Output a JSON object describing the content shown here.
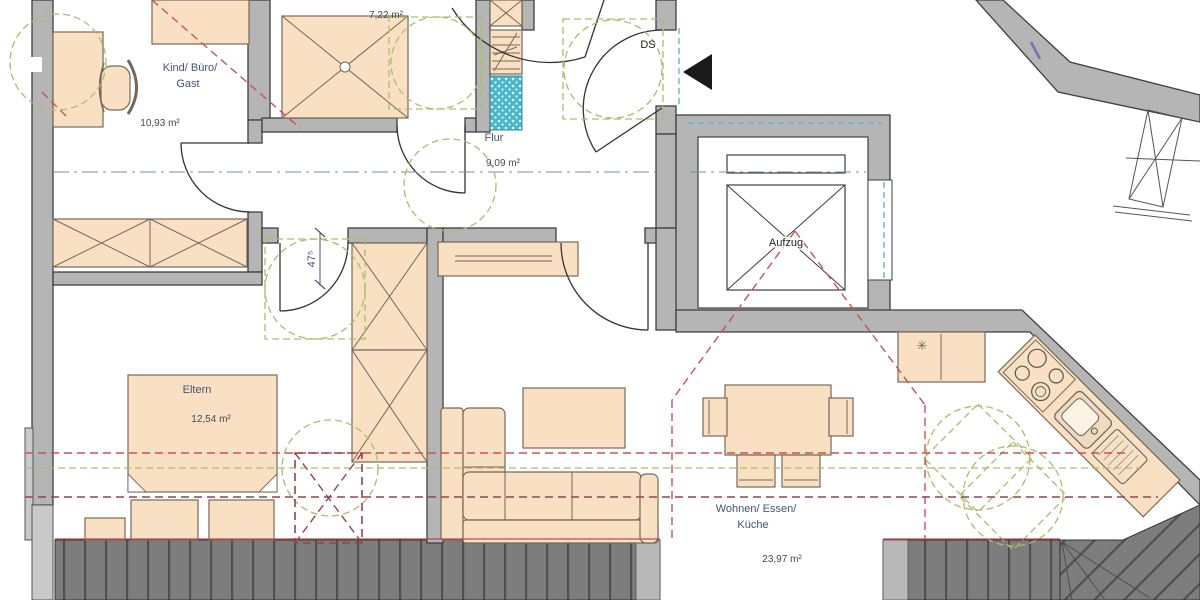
{
  "plan": {
    "rooms": {
      "kind": {
        "label_line1": "Kind/ Büro/",
        "label_line2": "Gast",
        "area": "10,93 m²"
      },
      "bad": {
        "area": "7,22 m²"
      },
      "flur": {
        "label": "Flur",
        "area": "9,09 m²"
      },
      "eltern": {
        "label": "Eltern",
        "area": "12,54 m²"
      },
      "wohnen": {
        "label_line1": "Wohnen/ Essen/",
        "label_line2": "Küche",
        "area": "23,97 m²"
      }
    },
    "annotations": {
      "entrance_abbr": "DS",
      "elevator_label": "Aufzug",
      "door_width_dim": "47⁵",
      "cooktop_symbol": "✳"
    },
    "colors": {
      "wall_gray": "#b5b5b5",
      "furniture_peach": "#f9e0c2",
      "accessibility_green": "#a9bd6f",
      "roofline_red": "#c65353",
      "roofline_maroon": "#91454f",
      "entry_cyan": "#62b8cc",
      "shower_blue": "#49b6cc",
      "deck_gray": "#7d7d7d",
      "label_blue": "#44537a",
      "entrance_arrow_black": "#1a1a1a"
    }
  }
}
